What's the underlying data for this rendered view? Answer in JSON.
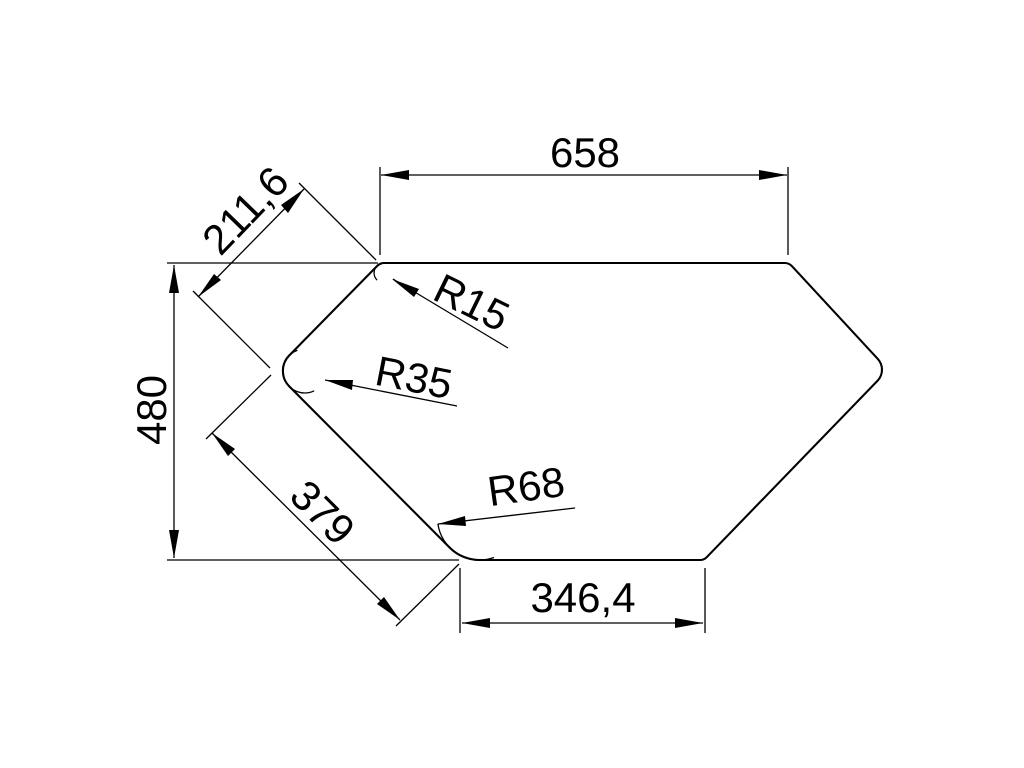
{
  "page": {
    "background": "#ffffff",
    "line_color": "#000000",
    "text_color": "#000000"
  },
  "drawing": {
    "kind": "technical-outline-dimension-drawing",
    "shape": "hexagonal corner-basin outline with filleted corners",
    "linear_dimensions": [
      {
        "id": "top_width",
        "value": "658",
        "orientation": "horizontal"
      },
      {
        "id": "left_height",
        "value": "480",
        "orientation": "vertical"
      },
      {
        "id": "upper_left_edge",
        "value": "211,6",
        "orientation": "diagonal-45"
      },
      {
        "id": "lower_left_edge",
        "value": "379",
        "orientation": "diagonal-45"
      },
      {
        "id": "bottom_width",
        "value": "346,4",
        "orientation": "horizontal"
      }
    ],
    "radius_dimensions": [
      {
        "id": "top_left_fillet",
        "label": "R15"
      },
      {
        "id": "left_fillet",
        "label": "R35"
      },
      {
        "id": "bottom_left_fillet",
        "label": "R68"
      }
    ]
  }
}
